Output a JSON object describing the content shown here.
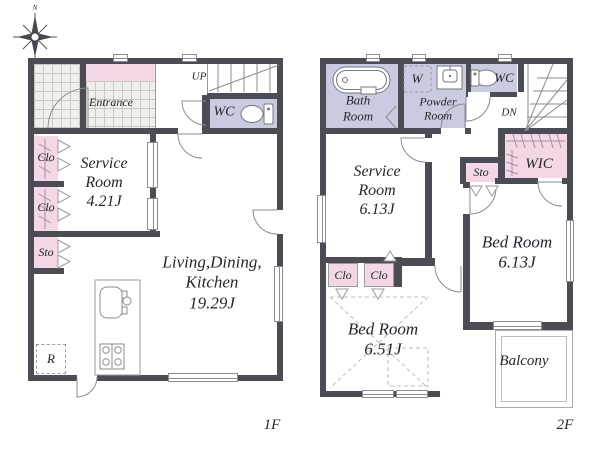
{
  "title": "2-story house floor plan",
  "colors": {
    "wall": "#4c4c55",
    "closet_pink": "#f4d7e6",
    "wet_area_lavender": "#c9cce1",
    "tile_line": "#c9c7c2",
    "linework": "#8b8b93",
    "text": "#26262e"
  },
  "icons": {
    "compass": "compass-rose-icon",
    "toilet": "toilet-icon",
    "bathtub": "bathtub-icon",
    "sink": "sink-icon",
    "washer": "washer-outline",
    "kitchen_sink": "kitchen-sink-icon",
    "stove": "stove-icon",
    "refrigerator": "refrigerator-area"
  },
  "compass": {
    "north": "N"
  },
  "floor1": {
    "floor_label": "1F",
    "entrance": "Entrance",
    "up": "UP",
    "wc": "WC",
    "clo_top": "Clo",
    "clo_bottom": "Clo",
    "sto": "Sto",
    "service_room": {
      "lines": [
        "Service",
        "Room",
        "4.21J"
      ]
    },
    "ldk": {
      "lines": [
        "Living,Dining,",
        "Kitchen",
        "19.29J"
      ]
    },
    "refrigerator": "R"
  },
  "floor2": {
    "floor_label": "2F",
    "bath_room": {
      "lines": [
        "Bath",
        "Room"
      ]
    },
    "washer": "W",
    "powder_room": {
      "lines": [
        "Powder",
        "Room"
      ]
    },
    "wc": "WC",
    "dn": "DN",
    "wic": "WIC",
    "sto": "Sto",
    "service_room": {
      "lines": [
        "Service",
        "Room",
        "6.13J"
      ]
    },
    "clo_left": "Clo",
    "clo_right": "Clo",
    "bed_room_a": {
      "lines": [
        "Bed Room",
        "6.51J"
      ]
    },
    "bed_room_b": {
      "lines": [
        "Bed Room",
        "6.13J"
      ]
    },
    "balcony": "Balcony"
  }
}
